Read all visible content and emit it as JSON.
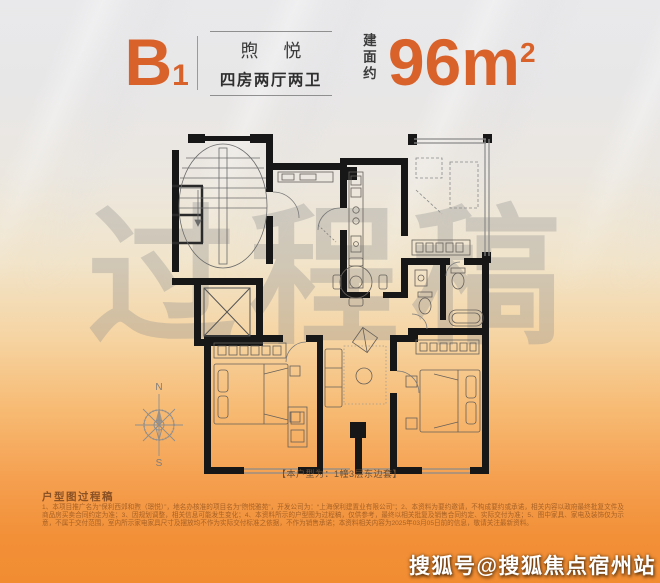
{
  "header": {
    "unit_code": "B",
    "unit_code_sub": "1",
    "project_name": "煦 悦",
    "layout_desc": "四房两厅两卫",
    "area_label": "建面约",
    "area_value": "96m",
    "area_exponent": "2"
  },
  "watermark_text": "过程稿",
  "compass": {
    "north": "N",
    "south": "S"
  },
  "plan_caption": "【本户型为：1幢3层东边套】",
  "footer": {
    "title": "户型图过程稿",
    "disclaimer": "1、本项目推广名为“保利西郊和煦（璟悦）”，地名办核准的项目名为“煦悦雅苑”，开发公司为：“上海保利建置业有限公司”；2、本资料为要约邀请，不构成要约或承诺，相关内容以政府最终批复文件及商品房买卖合同约定为准；3、因规划调整，相关信息可能发生变化；4、本资料所示的户型图为过程稿，仅供参考，最终以相关批复及销售合同约定、实际交付为准；5、图中家具、家电及装饰仅为示意，不属于交付范围，室内所示家电家具尺寸及摆放均不作为实际交付标准之依据，不作为销售承诺；本资料相关内容为2025年03月05日前的信息，敬请关注最新资料。"
  },
  "branding_watermark": "搜狐号@搜狐焦点宿州站",
  "colors": {
    "accent": "#d9622b",
    "orange_band": "#f18c31",
    "watermark_gray": "#8f8f8f"
  }
}
